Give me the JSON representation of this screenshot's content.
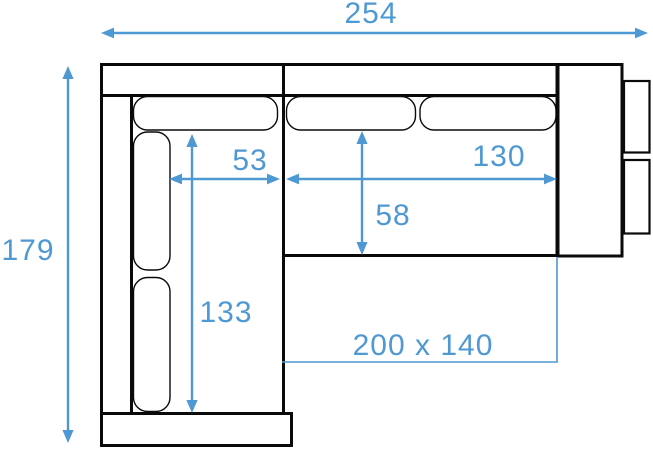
{
  "diagram": {
    "kind": "corner-sofa-top-view-dimension-drawing",
    "colors": {
      "accent": "#4e99d3",
      "outline": "#0a0a0a",
      "background": "#ffffff"
    },
    "dimensions": {
      "total_width": "254",
      "total_depth": "179",
      "chaise_seat_width": "53",
      "right_seat_width": "130",
      "right_seat_depth": "58",
      "chaise_seat_length": "133",
      "sleeping_area": "200 x 140"
    }
  }
}
